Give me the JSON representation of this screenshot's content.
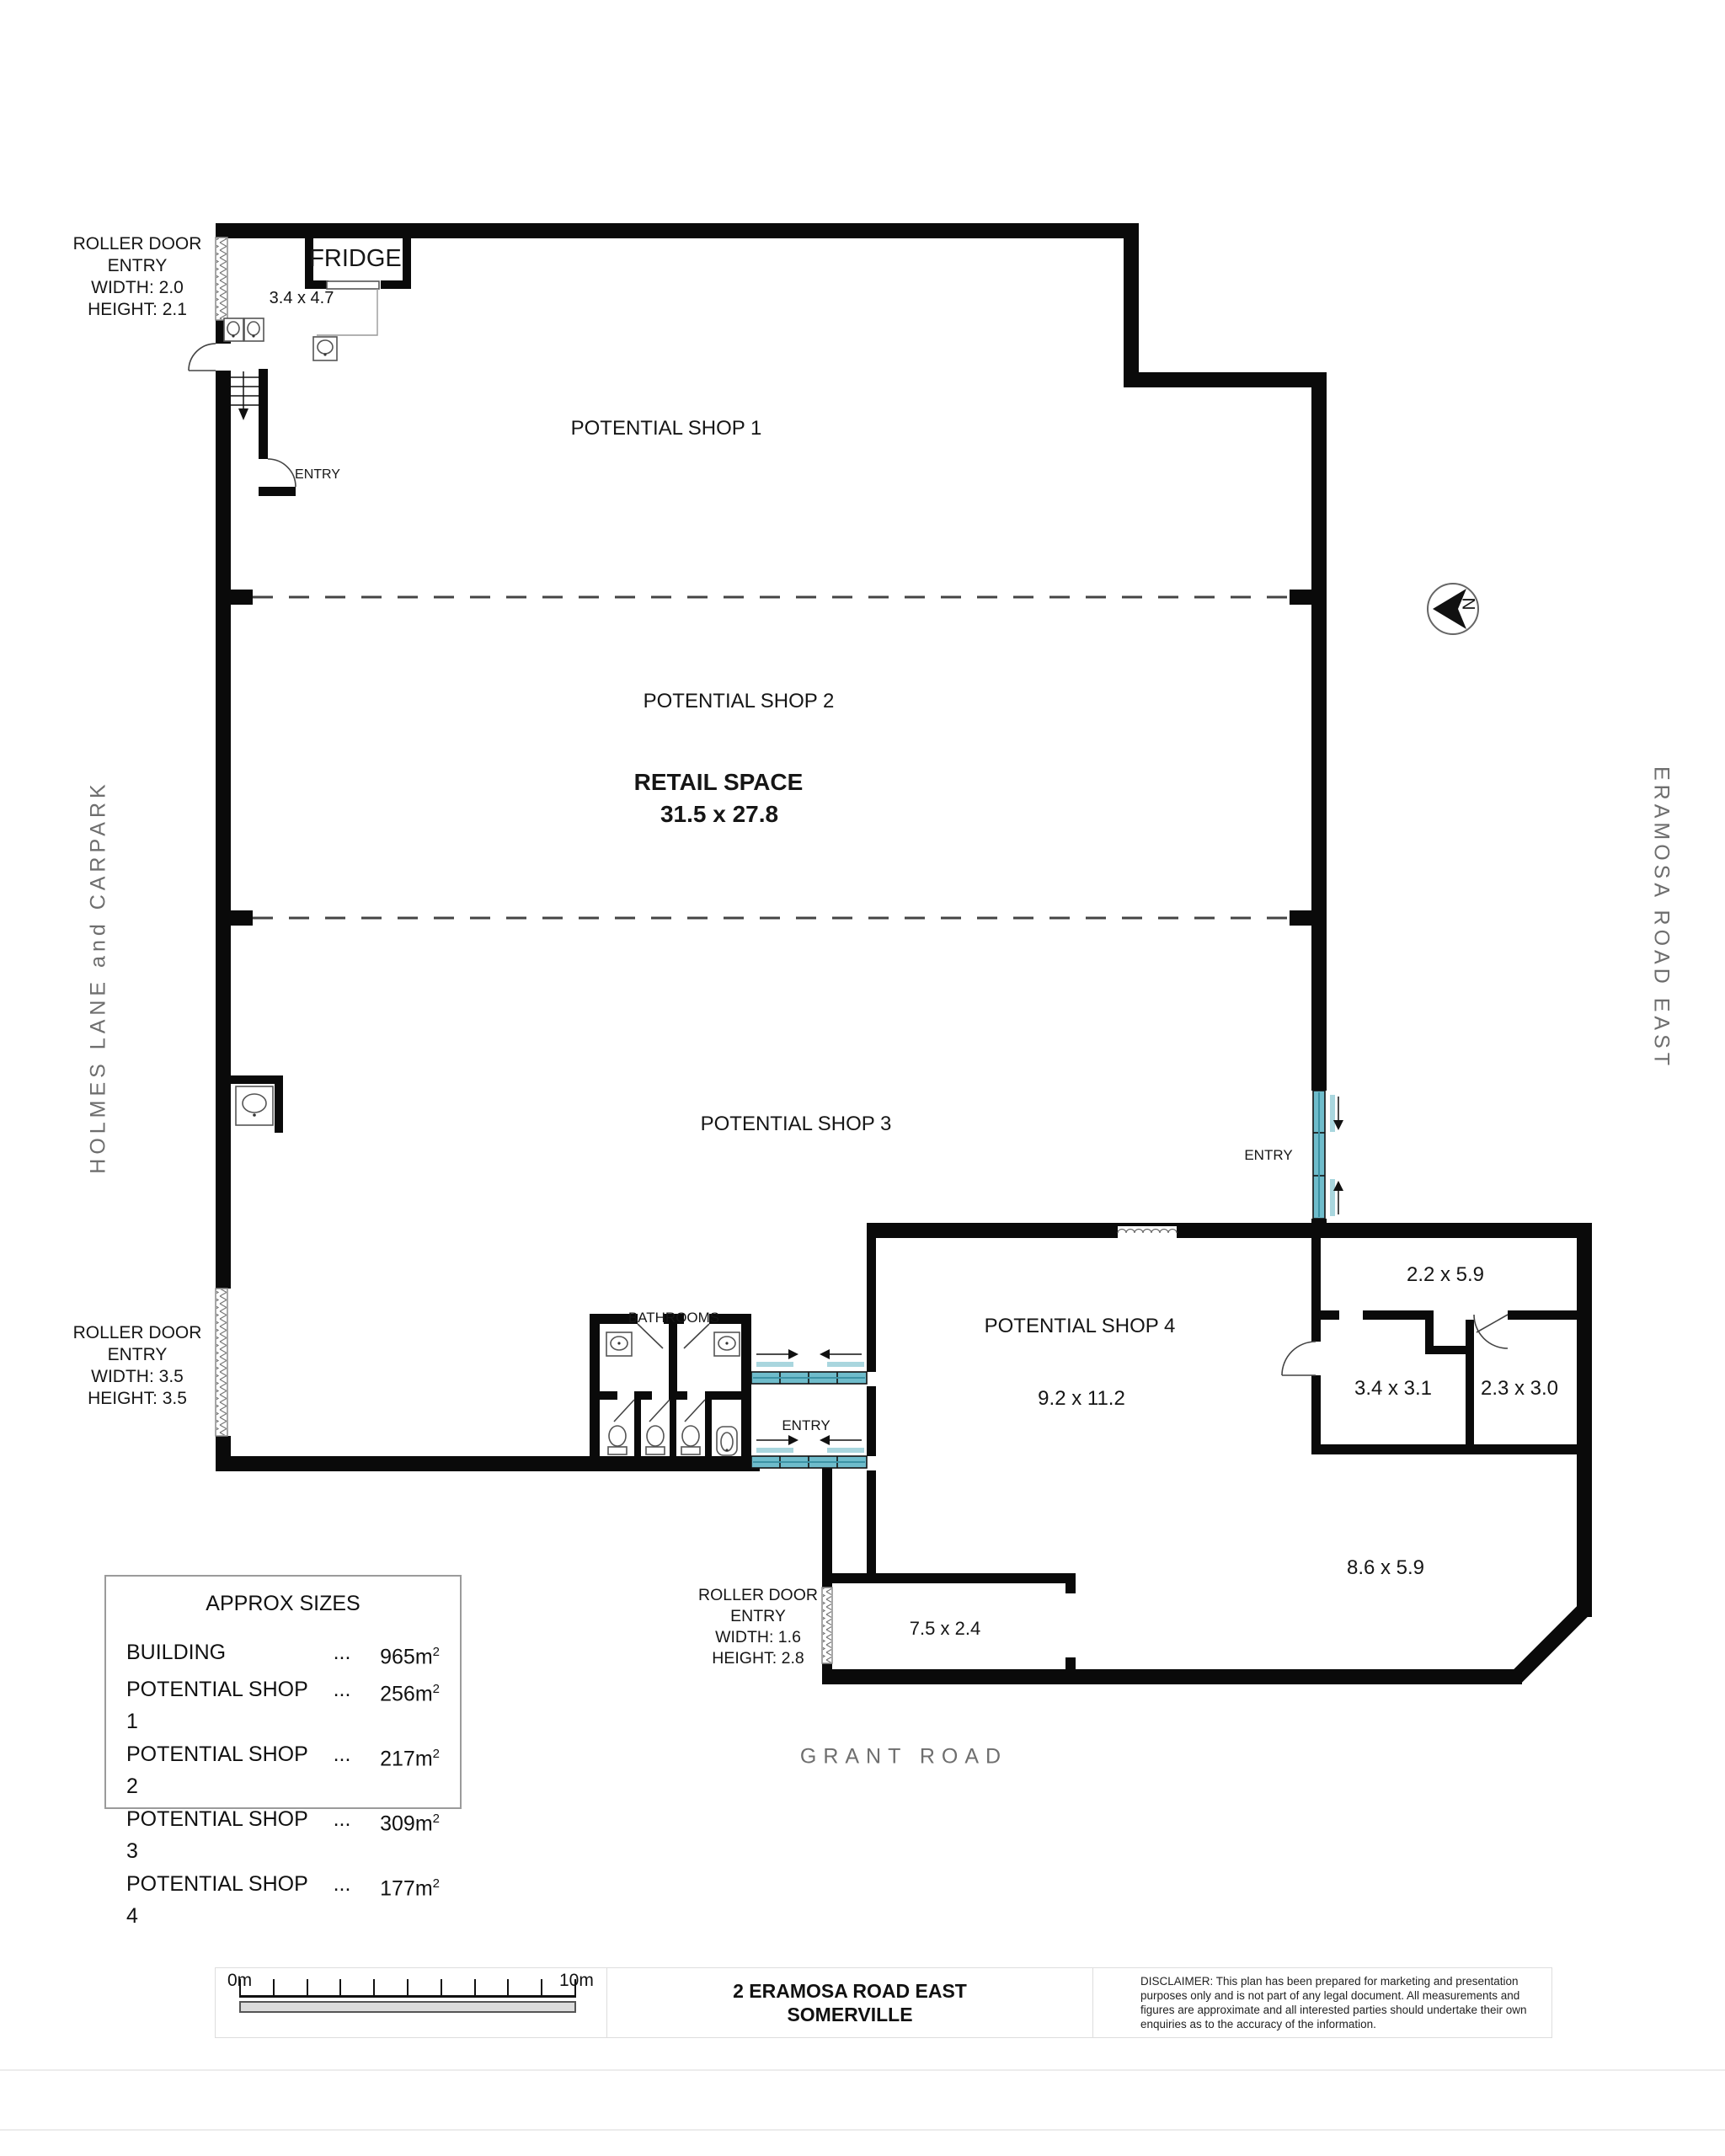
{
  "plan": {
    "labels": {
      "shop1": "POTENTIAL SHOP 1",
      "shop2": "POTENTIAL SHOP 2",
      "shop3": "POTENTIAL SHOP 3",
      "shop4": "POTENTIAL SHOP 4",
      "retail_space": "RETAIL SPACE",
      "retail_dims": "31.5 x 27.8",
      "shop4_dims": "9.2 x 11.2",
      "fridge": "FRIDGE",
      "fridge_dims": "3.4 x 4.7",
      "bathrooms": "BATHROOMS",
      "entry": "ENTRY",
      "north": "N",
      "room_2_2x5_9": "2.2 x 5.9",
      "room_3_4x3_1": "3.4 x 3.1",
      "room_2_3x3_0": "2.3 x 3.0",
      "room_8_6x5_9": "8.6 x 5.9",
      "room_7_5x2_4": "7.5 x 2.4"
    },
    "roller_door_top": {
      "lines": [
        "ROLLER DOOR",
        "ENTRY",
        "WIDTH: 2.0",
        "HEIGHT: 2.1"
      ]
    },
    "roller_door_mid": {
      "lines": [
        "ROLLER DOOR",
        "ENTRY",
        "WIDTH: 3.5",
        "HEIGHT: 3.5"
      ]
    },
    "roller_door_bottom": {
      "lines": [
        "ROLLER DOOR",
        "ENTRY",
        "WIDTH: 1.6",
        "HEIGHT: 2.8"
      ]
    },
    "roads": {
      "left": "HOLMES  LANE  and  CARPARK",
      "right": "ERAMOSA  ROAD  EAST",
      "bottom": "GRANT  ROAD"
    }
  },
  "sizes_box": {
    "title": "APPROX SIZES",
    "rows": [
      {
        "label": "BUILDING",
        "dots": "...",
        "value": "965m",
        "sup": "2"
      },
      {
        "label": "POTENTIAL SHOP 1",
        "dots": "...",
        "value": "256m",
        "sup": "2"
      },
      {
        "label": "POTENTIAL SHOP 2",
        "dots": "...",
        "value": "217m",
        "sup": "2"
      },
      {
        "label": "POTENTIAL SHOP 3",
        "dots": "...",
        "value": "309m",
        "sup": "2"
      },
      {
        "label": "POTENTIAL SHOP 4",
        "dots": "...",
        "value": "177m",
        "sup": "2"
      }
    ]
  },
  "footer": {
    "scale_start": "0m",
    "scale_end": "10m",
    "address_line1": "2 ERAMOSA ROAD EAST",
    "address_line2": "SOMERVILLE",
    "disclaimer": "DISCLAIMER: This plan has been prepared for marketing and presentation purposes only and is not part of any legal document. All measurements and figures are approximate and all interested parties should undertake their own enquiries as to the accuracy of the information."
  },
  "colors": {
    "wall": "#0a0a0a",
    "door_teal": "#6fbccb",
    "door_teal_light": "#a9d6de",
    "road_gray": "#6e6e6e"
  }
}
